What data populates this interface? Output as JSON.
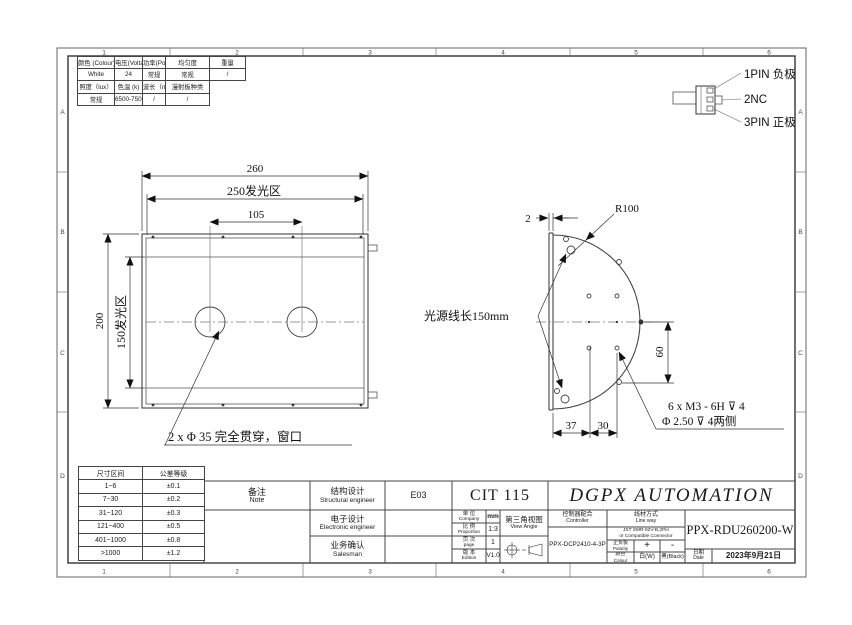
{
  "sheet": {
    "zones_top": [
      "1",
      "2",
      "3",
      "4",
      "5",
      "6"
    ],
    "zones_side": [
      "A",
      "B",
      "C",
      "D"
    ]
  },
  "spec_table": {
    "rows": [
      [
        "颜色 (Colour)",
        "电压(Voltage)",
        "功率(Power)",
        "均匀度",
        "重量"
      ],
      [
        "White",
        "24",
        "常规",
        "常规",
        "/"
      ],
      [
        "照度（lux）",
        "色温 (k)",
        "波长（nm）",
        "漫射板种类"
      ],
      [
        "常规",
        "6500-7500",
        "/",
        "/"
      ]
    ]
  },
  "connector_callout": {
    "pin1": "1PIN 负极",
    "pin2": "2NC",
    "pin3": "3PIN 正极"
  },
  "front_view": {
    "dim_width": "260",
    "dim_emitting_width": "250发光区",
    "dim_hole_spacing": "105",
    "dim_height": "200",
    "dim_emitting_height": "150发光区",
    "hole_note": "2 x Φ 35 完全贯穿，窗口"
  },
  "side_view": {
    "dim_thickness": "2",
    "radius_label": "R100",
    "cable_note": "光源线长150mm",
    "dim_height": "60",
    "dim_offset_a": "37",
    "dim_offset_b": "30",
    "thread_note_line1": "6 x M3 - 6H ⊽ 4",
    "thread_note_line2": "Φ 2.50 ⊽ 4两侧"
  },
  "tolerance_table": {
    "headers": [
      "尺寸区间",
      "公差等级"
    ],
    "rows": [
      [
        "1~6",
        "±0.1"
      ],
      [
        "7~30",
        "±0.2"
      ],
      [
        "31~120",
        "±0.3"
      ],
      [
        "121~400",
        "±0.5"
      ],
      [
        "401~1000",
        "±0.8"
      ],
      [
        ">1000",
        "±1.2"
      ]
    ]
  },
  "title_block": {
    "note_cn": "备注",
    "note_en": "Note",
    "structural_cn": "结构设计",
    "structural_en": "Structural engineer",
    "structural_value": "E03",
    "electronic_cn": "电子设计",
    "electronic_en": "Electronic engineer",
    "salesman_cn": "业务确认",
    "salesman_en": "Salesman",
    "drawing_code": "CIT 115",
    "company_name": "DGPX AUTOMATION",
    "unit_cn": "单 位",
    "unit_en": "Company",
    "unit_value": "mm",
    "proportion_cn": "比 例",
    "proportion_en": "Proportion",
    "proportion_value": "1:3",
    "page_cn": "页 次",
    "page_en": "page",
    "page_value": "1",
    "edition_cn": "版 本",
    "edition_en": "Edition",
    "edition_value": "V1.0",
    "view_cn": "第三角视图",
    "view_en": "View Angle",
    "controller_cn": "控制器配合",
    "controller_en": "Controller",
    "controller_value": "PPX-DCP2410-4-3P",
    "lineway_cn": "线材方式",
    "lineway_en": "Line way",
    "lineway_value1": "JST SMR-02V-B,2Pin",
    "lineway_value2": "or Compatible Connector",
    "polarity_cn": "正负极",
    "polarity_en": "Polarity",
    "polarity_plus": "+",
    "polarity_minus": "-",
    "colour_cn": "颜色",
    "colour_en": "Colour",
    "colour_white": "白(W)",
    "colour_black": "黑(Black)",
    "part_number": "PPX-RDU260200-W",
    "date_cn": "日期",
    "date_en": "Date",
    "date_value": "2023年9月21日"
  }
}
